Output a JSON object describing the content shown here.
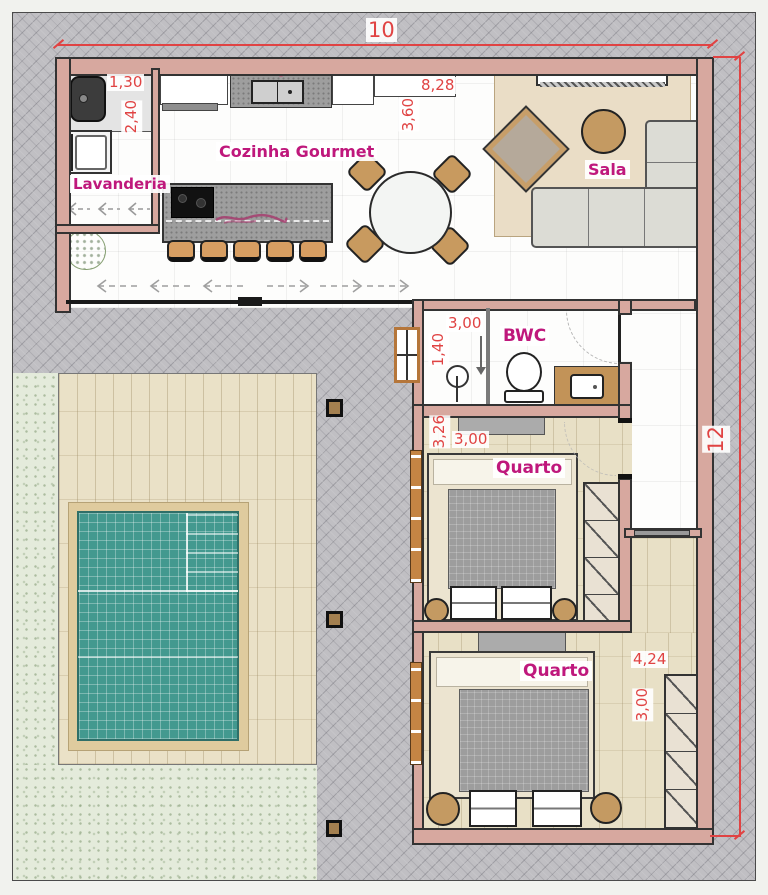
{
  "title": "Residential floor plan with pool",
  "labels": {
    "laundry": "Lavanderia",
    "kitchen": "Cozinha Gourmet",
    "living": "Sala",
    "bathroom": "BWC",
    "bedroom1": "Quarto",
    "bedroom2": "Quarto"
  },
  "dimensions": {
    "lot_width": "10",
    "lot_depth": "12",
    "laundry_width": "1,30",
    "laundry_depth": "2,40",
    "social_width": "8,28",
    "social_depth": "3,60",
    "bathroom_width": "3,00",
    "bathroom_depth": "1,40",
    "bedroom1_depth": "3,26",
    "bedroom1_width": "3,00",
    "bedroom2_width": "4,24",
    "bedroom2_depth": "3,00"
  },
  "colors": {
    "label-magenta": "#bf187c",
    "dimension-red": "#e04343",
    "wall-fill": "#d7a89f",
    "wall-line": "#333333",
    "paver-gray": "#c0bfc3",
    "grass-green": "#e4ebdb",
    "deck-beige": "#eae1c7",
    "pool-teal": "#43998f",
    "pool-border-tan": "#dfcb9e",
    "wood-floor": "#e8e0c6",
    "rug-beige": "#eaddc6",
    "sofa-gray": "#dcdcd5",
    "furniture-tan": "#c89a5f",
    "counter-gray": "#9e9e9e",
    "window-orange": "#c58544"
  }
}
